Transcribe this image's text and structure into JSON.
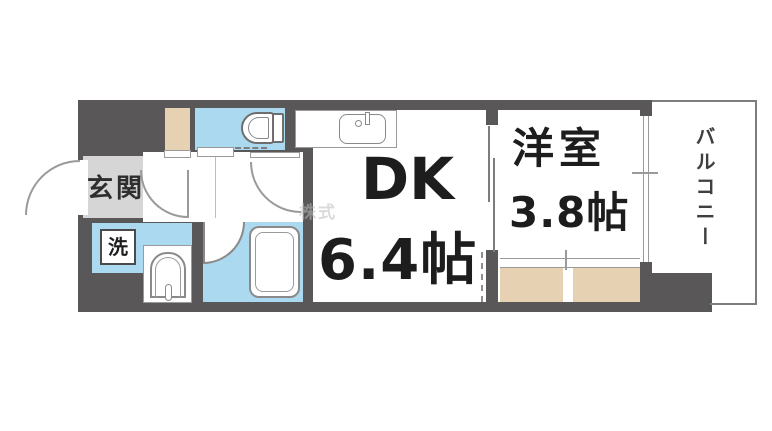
{
  "floor_plan": {
    "entrance": {
      "label": "玄関"
    },
    "washer_space": {
      "label": "洗"
    },
    "dining_kitchen": {
      "label": "DK",
      "size": "6.4帖"
    },
    "western_room": {
      "label": "洋室",
      "size": "3.8帖"
    },
    "balcony": {
      "label": "バルコニー"
    },
    "watermark": "株式",
    "colors": {
      "wall": "#595757",
      "water_rooms": "#abd9f0",
      "storage_closet": "#e6d2b3",
      "entrance_floor": "#d6d6d6",
      "room_floor": "#ffffff"
    }
  }
}
